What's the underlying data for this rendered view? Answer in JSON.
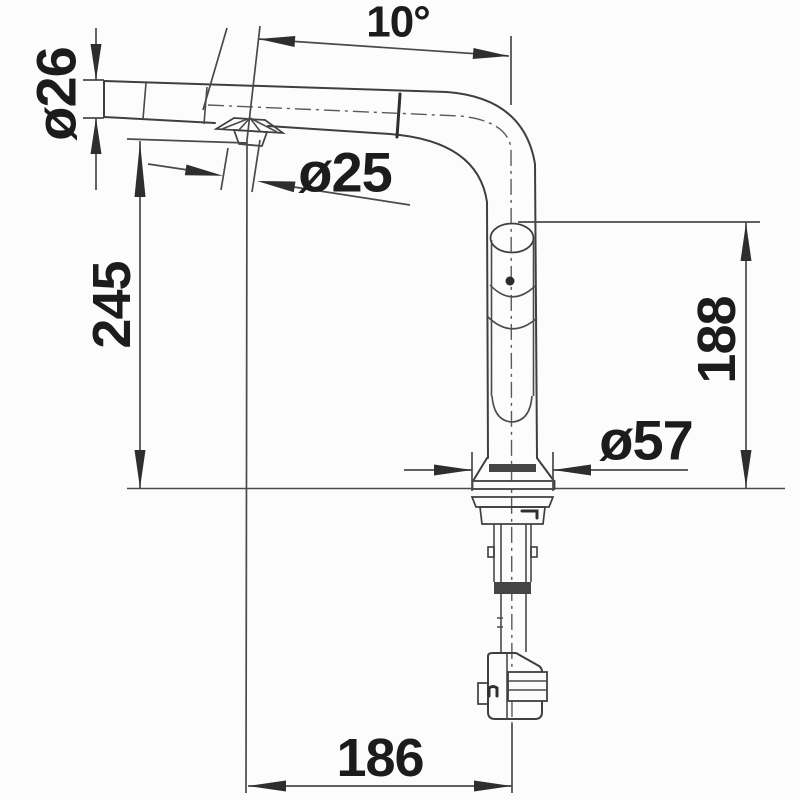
{
  "drawing": {
    "subject": "pull-out kitchen faucet side elevation with dimensions",
    "dimension_labels": {
      "spout_angle": "10°",
      "spout_tube_diameter": "ø26",
      "spray_head_diameter": "ø25",
      "height_to_spout": "245",
      "height_to_handle_top": "188",
      "base_diameter": "ø57",
      "spout_reach": "186"
    },
    "colors": {
      "background": "#fcfcfc",
      "line": "#3f3f3f",
      "text": "#1c1c1c"
    }
  }
}
